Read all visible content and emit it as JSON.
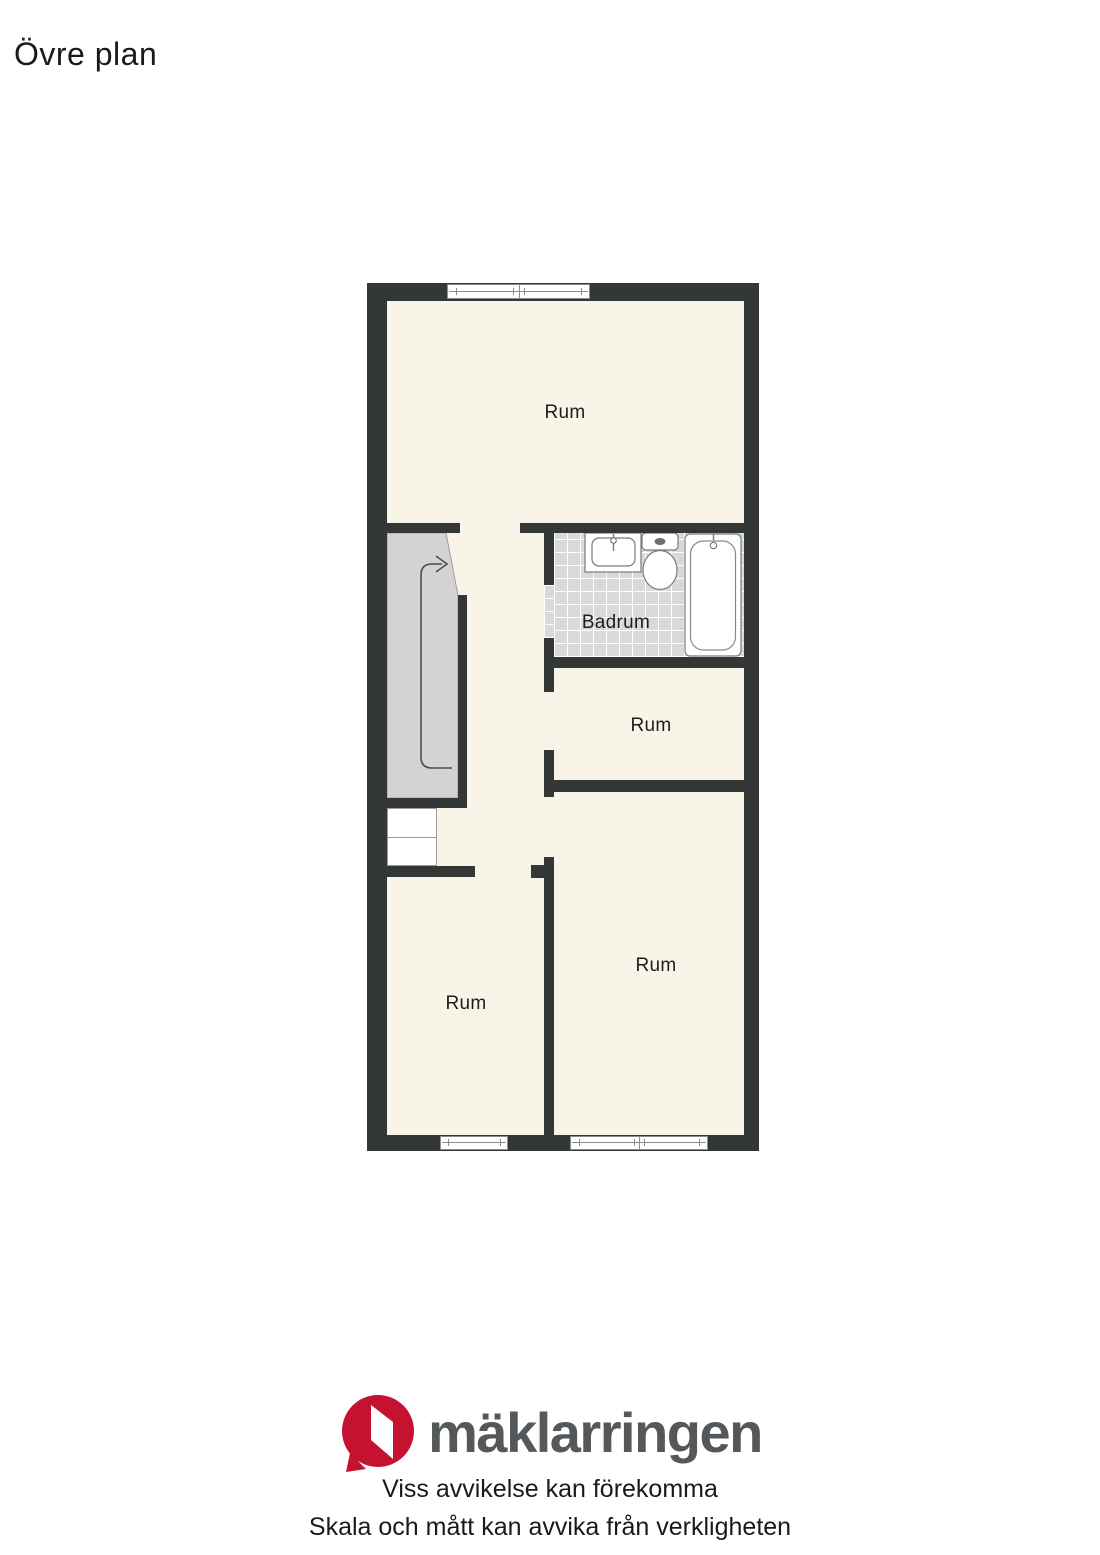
{
  "title": "Övre plan",
  "floorplan": {
    "rooms": [
      {
        "label": "Rum"
      },
      {
        "label": "Badrum"
      },
      {
        "label": "Rum"
      },
      {
        "label": "Rum"
      },
      {
        "label": "Rum"
      }
    ],
    "bathroom_fixtures": [
      "sink-icon",
      "toilet-icon",
      "bathtub-icon"
    ],
    "stairs_icon": "stairs-up-arrow-icon"
  },
  "footer": {
    "brand": "mäklarringen",
    "brand_icon": "maklarringen-speech-bubble-icon",
    "disclaimer_line1": "Viss avvikelse kan förekomma",
    "disclaimer_line2": "Skala och mått kan avvika från verkligheten"
  },
  "colors": {
    "wall": "#333836",
    "floor": "#f8f4e7",
    "tile": "#d9d9d9",
    "stair": "#d3d3d3",
    "brand_red": "#c51230",
    "brand_gray": "#54585a",
    "text": "#1a1a1a",
    "fixture_stroke": "#7a7a7a"
  }
}
